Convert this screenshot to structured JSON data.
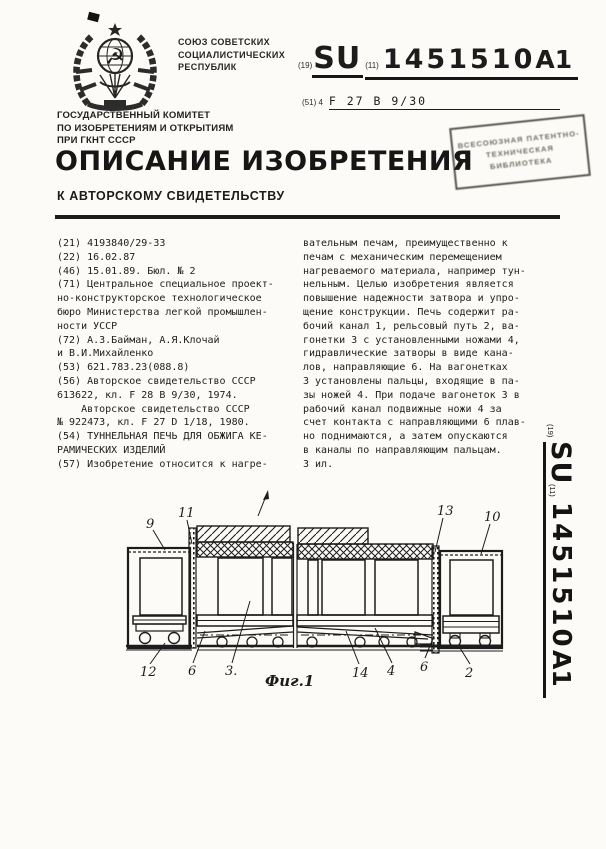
{
  "header": {
    "union_lines": [
      "СОЮЗ СОВЕТСКИХ",
      "СОЦИАЛИСТИЧЕСКИХ",
      "РЕСПУБЛИК"
    ],
    "code19": "(19)",
    "country": "SU",
    "code11": "(11)",
    "doc_number": "1451510",
    "doc_kind": "A1",
    "ipc_label": "(51) 4",
    "ipc_code": "F 27 B 9/30",
    "committee_lines": [
      "ГОСУДАРСТВЕННЫЙ КОМИТЕТ",
      "ПО ИЗОБРЕТЕНИЯМ И ОТКРЫТИЯМ",
      "ПРИ ГКНТ СССР"
    ],
    "title": "ОПИСАНИЕ ИЗОБРЕТЕНИЯ",
    "subtitle": "К АВТОРСКОМУ СВИДЕТЕЛЬСТВУ",
    "stamp_lines": [
      "ВСЕСОЮЗНАЯ",
      "ПАТЕНТНО-ТЕХНИЧЕСКАЯ",
      "БИБЛИОТЕКА"
    ]
  },
  "left_column_lines": [
    "(21) 4193840/29-33",
    "(22) 16.02.87",
    "(46) 15.01.89. Бюл. № 2",
    "(71) Центральное специальное проект-",
    "но-конструкторское технологическое",
    "бюро Министерства легкой промышлен-",
    "ности УССР",
    "(72) А.З.Байман, А.Я.Клочай",
    "и В.И.Михайленко",
    "(53) 621.783.23(088.8)",
    "(56) Авторское свидетельство СССР",
    "613622, кл. F 28 B 9/30, 1974.",
    "    Авторское свидетельство СССР",
    "№ 922473, кл. F 27 D 1/18, 1980.",
    "(54) ТУННЕЛЬНАЯ ПЕЧЬ ДЛЯ ОБЖИГА КЕ-",
    "РАМИЧЕСКИХ ИЗДЕЛИЙ",
    "(57) Изобретение относится к нагре-"
  ],
  "right_column_lines": [
    "вательным печам, преимущественно к",
    "печам с механическим перемещением",
    "нагреваемого материала, например тун-",
    "нельным. Целью изобретения является",
    "повышение надежности затвора и упро-",
    "щение конструкции. Печь содержит ра-",
    "бочий канал 1, рельсовый путь 2, ва-",
    "гонетки 3 с установленными ножами 4,",
    "гидравлические затворы в виде кана-",
    "лов, направляющие 6. На вагонетках",
    "3 установлены пальцы, входящие в па-",
    "зы ножей 4. При подаче вагонеток 3 в",
    "рабочий канал подвижные ножи 4 за",
    "счет контакта с направляющими 6 плав-",
    "но поднимаются, а затем опускаются",
    "в каналы по направляющим пальцам.",
    "3 ил."
  ],
  "side_strip": {
    "code19": "(19)",
    "country": "SU",
    "code11": "(11)",
    "doc_number": "1451510",
    "doc_kind": "A1"
  },
  "figure": {
    "caption": "Фиг.1",
    "labels": [
      {
        "text": "9"
      },
      {
        "text": "11"
      },
      {
        "text": "13"
      },
      {
        "text": "10"
      },
      {
        "text": "12"
      },
      {
        "text": "6"
      },
      {
        "text": "3."
      },
      {
        "text": "14"
      },
      {
        "text": "4"
      },
      {
        "text": "6"
      },
      {
        "text": "2"
      }
    ]
  }
}
